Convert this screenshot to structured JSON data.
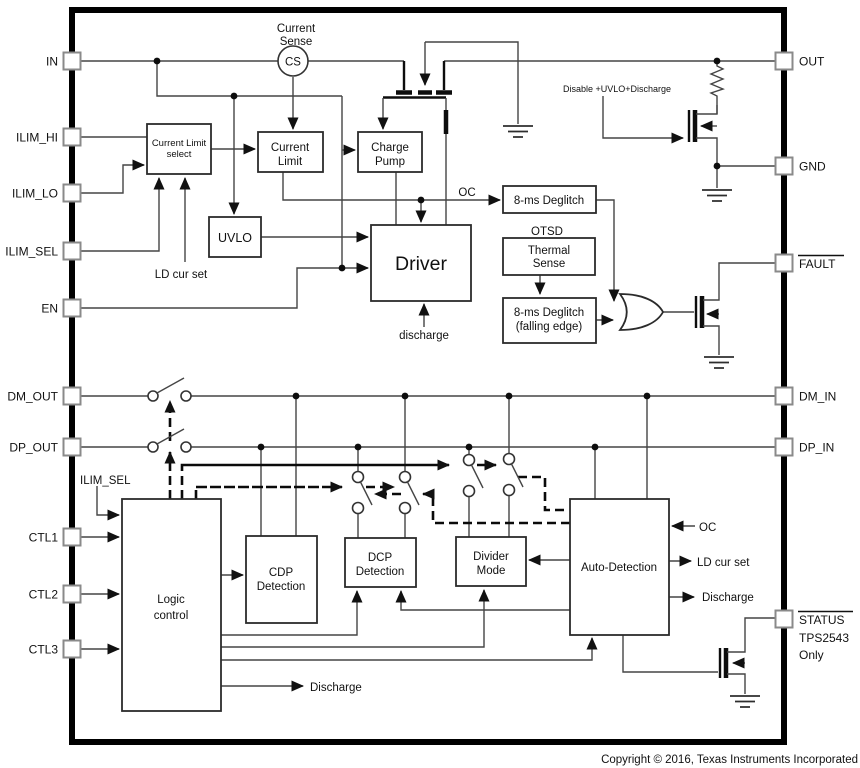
{
  "pins_left": [
    "IN",
    "ILIM_HI",
    "ILIM_LO",
    "ILIM_SEL",
    "EN",
    "DM_OUT",
    "DP_OUT",
    "CTL1",
    "CTL2",
    "CTL3"
  ],
  "pins_right": [
    "OUT",
    "GND",
    "FAULT",
    "DM_IN",
    "DP_IN",
    "STATUS"
  ],
  "blocks": {
    "current_limit_select": {
      "line1": "Current Limit",
      "line2": "select"
    },
    "current_limit": {
      "line1": "Current",
      "line2": "Limit"
    },
    "charge_pump": {
      "line1": "Charge",
      "line2": "Pump"
    },
    "uvlo": {
      "line1": "UVLO"
    },
    "driver": {
      "line1": "Driver"
    },
    "deglitch_oc": {
      "line1": "8-ms Deglitch"
    },
    "thermal_sense": {
      "line1": "Thermal",
      "line2": "Sense"
    },
    "deglitch_falling": {
      "line1": "8-ms Deglitch",
      "line2": "(falling edge)"
    },
    "cdp_detection": {
      "line1": "CDP",
      "line2": "Detection"
    },
    "dcp_detection": {
      "line1": "DCP",
      "line2": "Detection"
    },
    "divider_mode": {
      "line1": "Divider",
      "line2": "Mode"
    },
    "auto_detection": {
      "line1": "Auto-Detection"
    },
    "logic_control": {
      "line1": "Logic",
      "line2": "control"
    }
  },
  "labels": {
    "current_sense_line1": "Current",
    "current_sense_line2": "Sense",
    "cs": "CS",
    "oc_top": "OC",
    "otsd": "OTSD",
    "ld_cur_set": "LD cur set",
    "discharge_gate": "discharge",
    "disable_path": "Disable +UVLO+Discharge",
    "ilim_sel": "ILIM_SEL",
    "oc_auto": "OC",
    "ld_cur_set_auto": "LD cur set",
    "discharge_auto": "Discharge",
    "discharge_logic": "Discharge",
    "status_device": "TPS2543",
    "status_only": "Only"
  },
  "footer": {
    "copyright": "Copyright © 2016, Texas Instruments Incorporated"
  }
}
